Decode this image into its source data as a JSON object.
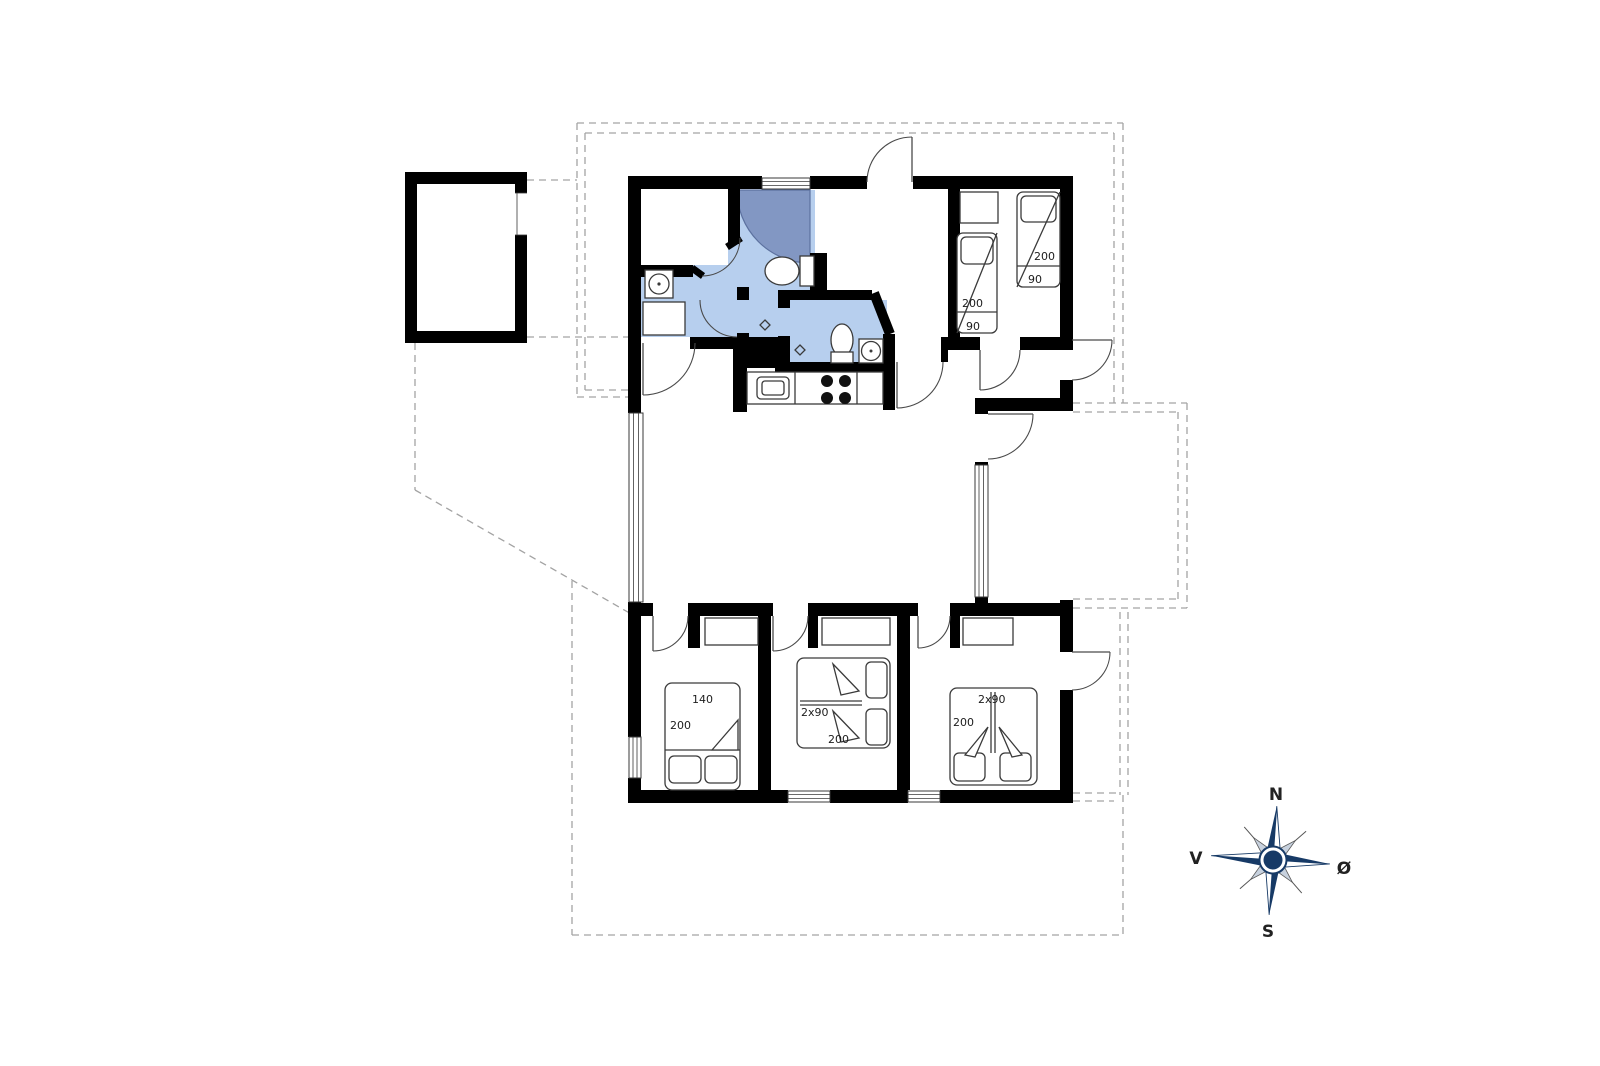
{
  "compass": {
    "north": "N",
    "east": "Ø",
    "south": "S",
    "west": "V"
  },
  "beds": {
    "top_right_room_bed_left": {
      "length": "200",
      "width": "90"
    },
    "top_right_room_bed_right": {
      "length": "200",
      "width": "90"
    },
    "bedroom_left": {
      "width": "140",
      "length": "200"
    },
    "bedroom_middle": {
      "config": "2x90",
      "length": "200"
    },
    "bedroom_right": {
      "config": "2x90",
      "length": "200"
    }
  },
  "colors": {
    "wall": "#000000",
    "bathroom_floor": "#b7cfee",
    "shower": "#8297c3",
    "dashed_outline": "#a3a3a3",
    "compass_navy": "#173a66"
  }
}
